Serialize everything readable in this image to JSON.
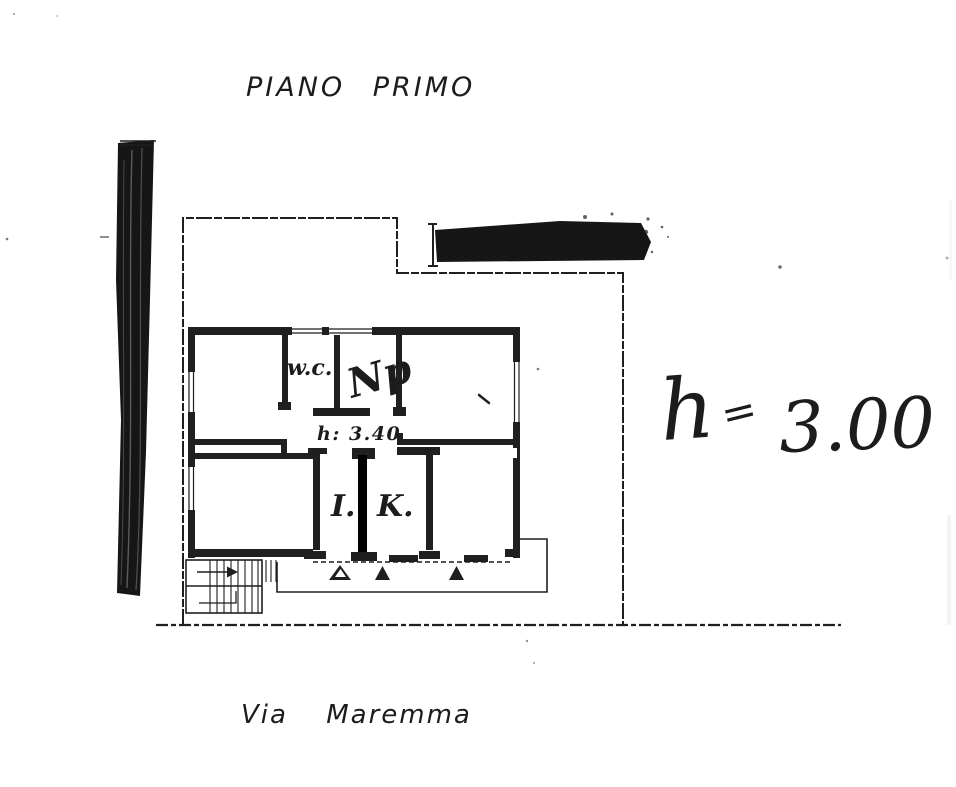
{
  "page": {
    "kind": "scanned cadastral floor plan",
    "title": "PIANO PRIMO",
    "street": "Via Maremma"
  },
  "plan": {
    "rooms": {
      "wc_label": "w.c.",
      "np_label": "Np",
      "i_label": "I.",
      "k_label": "K."
    },
    "printed_height_note": "h: 3.40",
    "entrance_marker_count": 3
  },
  "annotations": {
    "handwritten_height": {
      "lhs": "h",
      "eq": "=",
      "value": "3.00",
      "full": "h = 3.00"
    }
  },
  "colors": {
    "ink": "#1f1f1f",
    "paper": "#ffffff"
  }
}
